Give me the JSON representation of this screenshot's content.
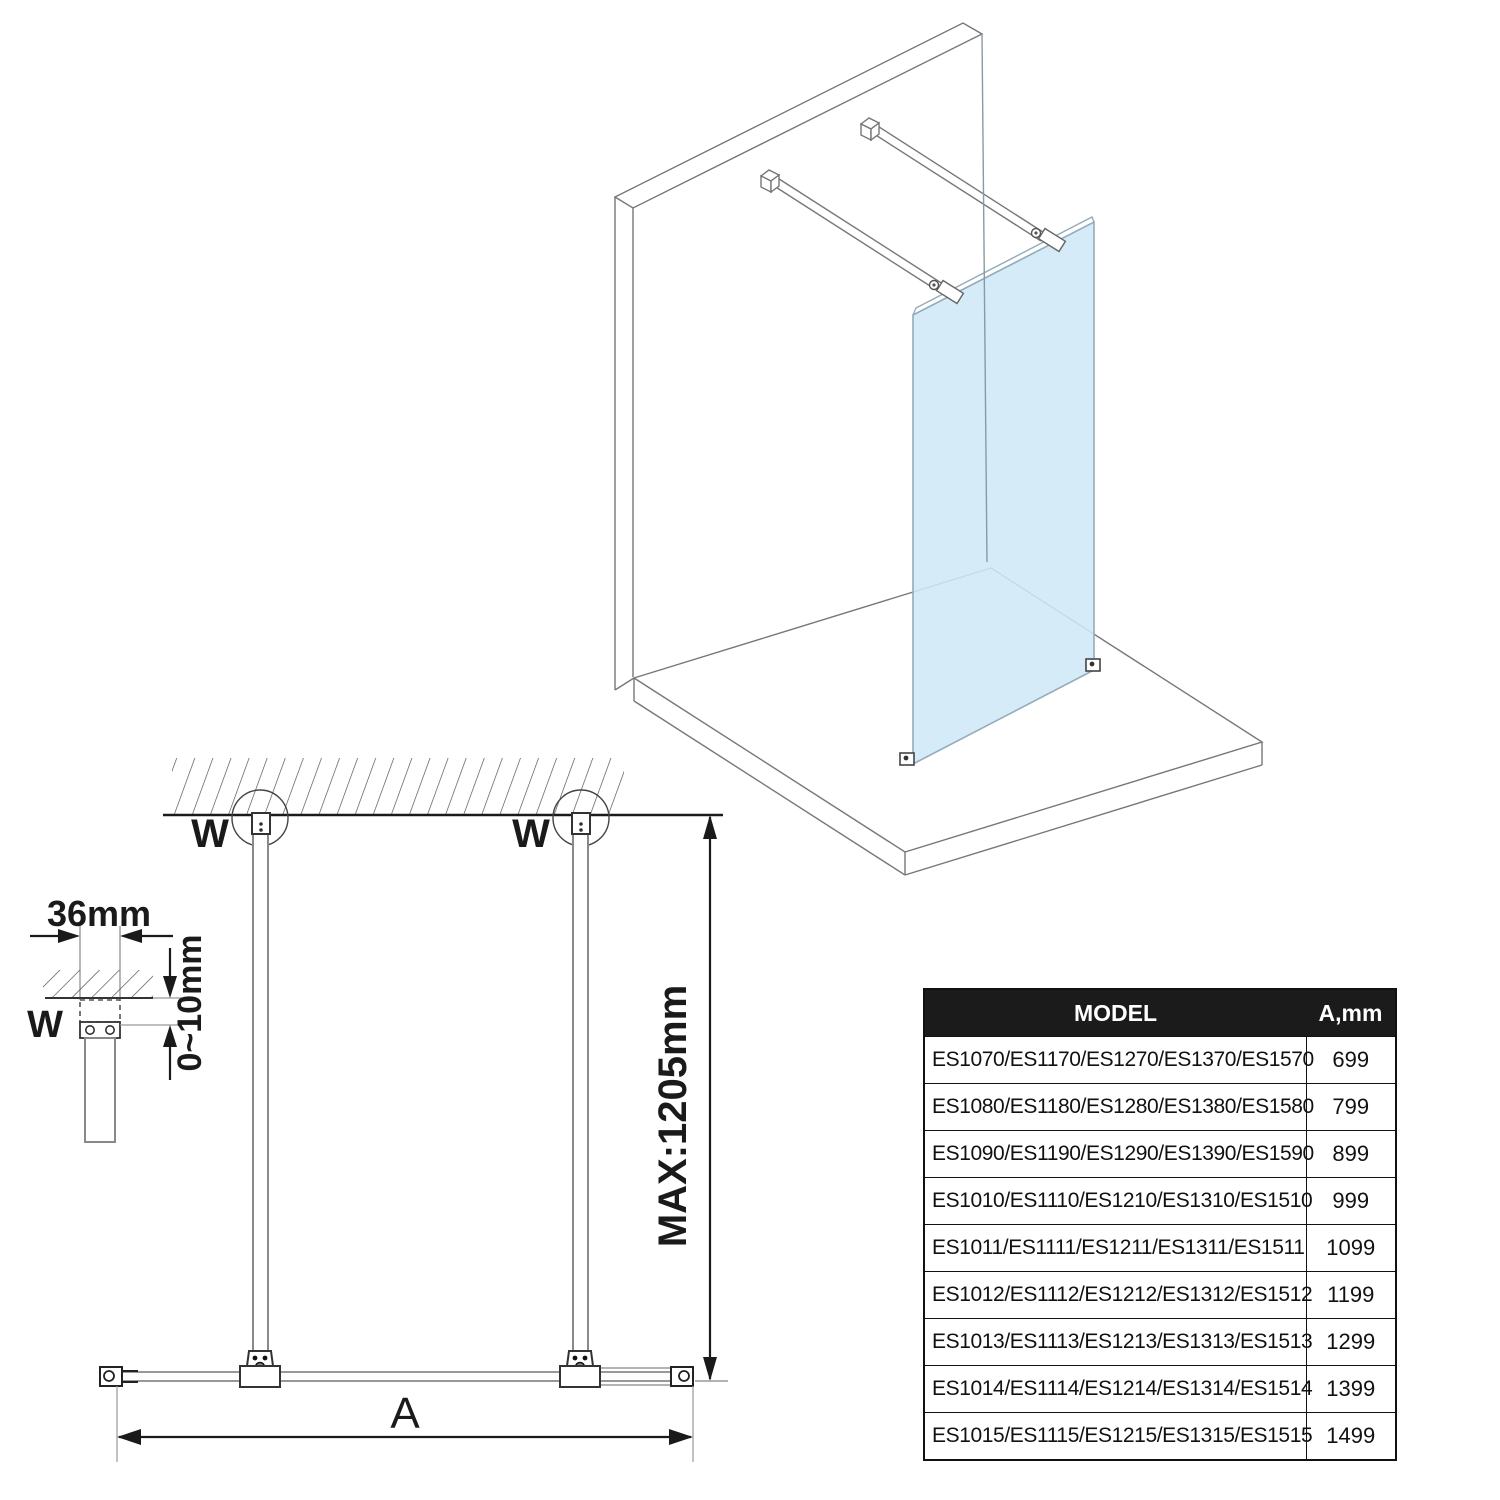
{
  "drawing": {
    "labels": {
      "wall_bracket": "W",
      "width_dim": "A",
      "bar_length_max": "MAX:1205mm",
      "bracket_width": "36mm",
      "adjust_range": "0~10mm"
    },
    "colors": {
      "glass_fill": "#cfe8f7",
      "glass_edge": "#93abbb",
      "drawing_line": "#777777",
      "dim_line": "#1a1a1a",
      "table_header_bg": "#1b1b1b"
    }
  },
  "table": {
    "headers": {
      "model": "MODEL",
      "a_mm": "A,mm"
    },
    "rows": [
      {
        "model": "ES1070/ES1170/ES1270/ES1370/ES1570",
        "a_mm": "699"
      },
      {
        "model": "ES1080/ES1180/ES1280/ES1380/ES1580",
        "a_mm": "799"
      },
      {
        "model": "ES1090/ES1190/ES1290/ES1390/ES1590",
        "a_mm": "899"
      },
      {
        "model": "ES1010/ES1110/ES1210/ES1310/ES1510",
        "a_mm": "999"
      },
      {
        "model": "ES1011/ES1111/ES1211/ES1311/ES1511",
        "a_mm": "1099"
      },
      {
        "model": "ES1012/ES1112/ES1212/ES1312/ES1512",
        "a_mm": "1199"
      },
      {
        "model": "ES1013/ES1113/ES1213/ES1313/ES1513",
        "a_mm": "1299"
      },
      {
        "model": "ES1014/ES1114/ES1214/ES1314/ES1514",
        "a_mm": "1399"
      },
      {
        "model": "ES1015/ES1115/ES1215/ES1315/ES1515",
        "a_mm": "1499"
      }
    ]
  }
}
